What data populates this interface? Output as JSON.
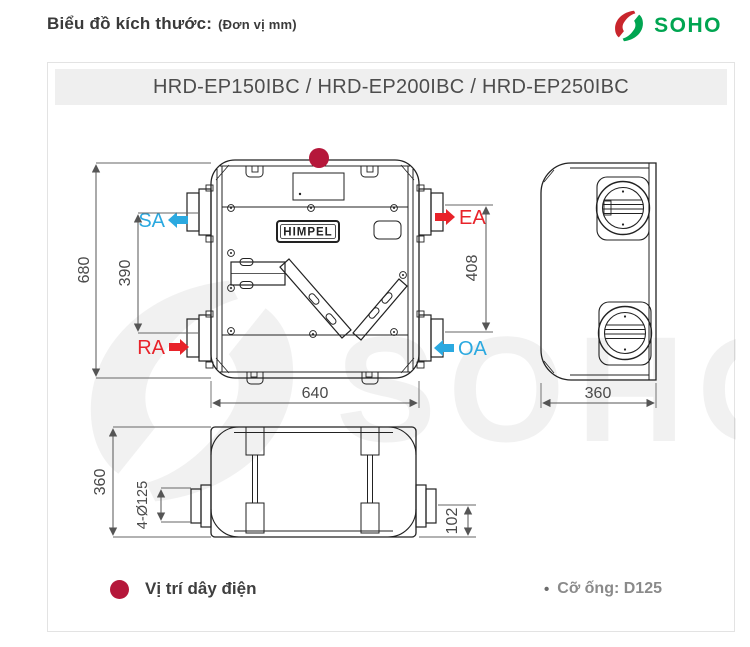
{
  "page": {
    "title": "Biểu đồ kích thước:",
    "unit": "(Đơn vị mm)"
  },
  "brand": {
    "name": "SOHO"
  },
  "panel": {
    "model_title": "HRD-EP150IBC / HRD-EP200IBC / HRD-EP250IBC"
  },
  "device": {
    "logo": "HIMPEL"
  },
  "ports": {
    "sa": "SA",
    "ea": "EA",
    "ra": "RA",
    "oa": "OA"
  },
  "dims": {
    "height": "680",
    "left_span": "390",
    "right_span": "408",
    "width": "640",
    "depth_side": "360",
    "depth_bottom": "360",
    "duct_holes": "4-Ø125",
    "bottom_offset": "102"
  },
  "legend": {
    "wire_label": "Vị trí dây điện",
    "pipe_bullet": "•",
    "pipe_label": "Cỡ ống: D125"
  },
  "colors": {
    "red": "#E8232A",
    "blue": "#2BA9E0",
    "crimson": "#B5173A",
    "brand_green": "#00A551",
    "brand_red": "#C9252C",
    "dim": "#555555",
    "line": "#222222"
  }
}
